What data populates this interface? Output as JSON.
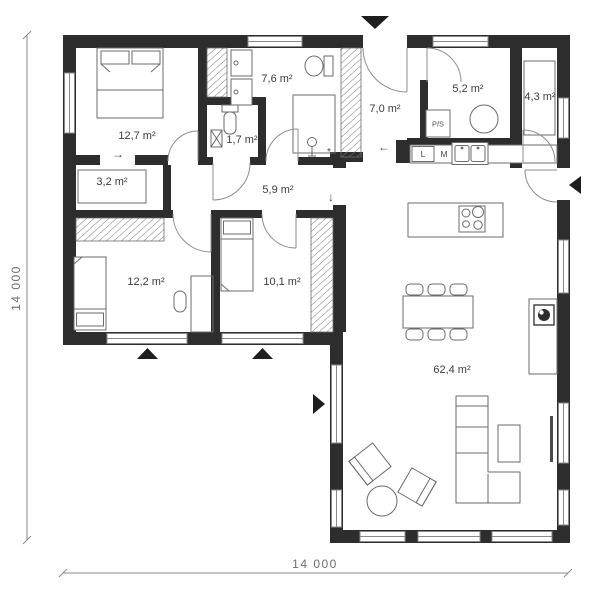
{
  "plan_title": "single-storey house floor plan",
  "dimensions": {
    "left": "14 000",
    "bottom": "14 000"
  },
  "rooms": {
    "bedroom_main": {
      "label": "12,7 m²"
    },
    "closet": {
      "label": "3,2 m²"
    },
    "bathroom": {
      "label": "7,6 m²"
    },
    "wc": {
      "label": "1,7 m²"
    },
    "corridor": {
      "label": "5,9 m²"
    },
    "hall": {
      "label": "7,0 m²"
    },
    "utility": {
      "label": "5,2 m²"
    },
    "pantry": {
      "label": "4,3 m²"
    },
    "bedroom_two": {
      "label": "12,2 m²"
    },
    "bedroom_three": {
      "label": "10,1 m²"
    },
    "living": {
      "label": "62,4 m²"
    }
  },
  "appliances": {
    "washer_dryer": "P/S",
    "fridge": "L",
    "dishwasher": "M"
  },
  "annotations": {
    "arrow_right": "→",
    "arrow_left": "←",
    "arrow_down": "↓",
    "asterisk": "*"
  },
  "colors": {
    "wall": "#2d2d2d",
    "furniture_line": "#6b6b6b",
    "glazing": "#8a8a8a",
    "label_text": "#3c3c3c",
    "dimension_text": "#6e6e6e"
  }
}
